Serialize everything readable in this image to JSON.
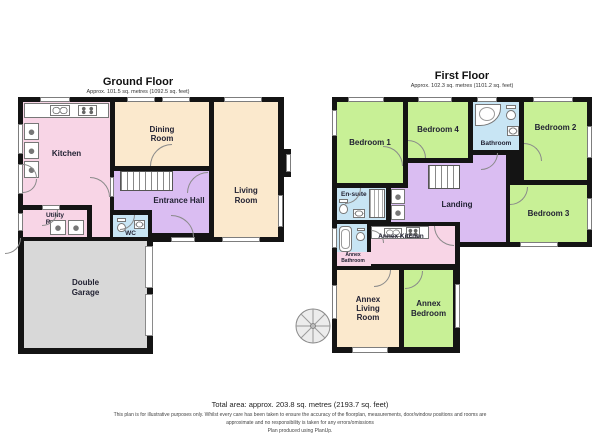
{
  "ground_floor": {
    "title": "Ground Floor",
    "subtitle": "Approx. 101.5 sq. metres (1092.5 sq. feet)",
    "rooms": {
      "kitchen": "Kitchen",
      "dining_room": "Dining Room",
      "living_room": "Living Room",
      "entrance_hall": "Entrance Hall",
      "utility_room": "Utility Room",
      "wc": "WC",
      "double_garage": "Double Garage"
    }
  },
  "first_floor": {
    "title": "First Floor",
    "subtitle": "Approx. 102.3 sq. metres (1101.2 sq. feet)",
    "rooms": {
      "bedroom_1": "Bedroom 1",
      "bedroom_2": "Bedroom 2",
      "bedroom_3": "Bedroom 3",
      "bedroom_4": "Bedroom 4",
      "bathroom": "Bathroom",
      "en_suite": "En-suite",
      "landing": "Landing",
      "annex_kitchen": "Annex Kitchen",
      "annex_bathroom": "Annex Bathroom",
      "annex_living_room": "Annex Living Room",
      "annex_bedroom": "Annex Bedroom"
    }
  },
  "footer": {
    "total_area": "Total area: approx. 203.8 sq. metres (2193.7 sq. feet)",
    "disclaimer": "This plan is for illustrative purposes only. Whilst every care has been taken to ensure the accuracy of the floorplan, measurements, door/window positions and rooms are approximate and no responsibility is taken for any errors/omissions",
    "credit": "Plan produced using PlanUp."
  },
  "colors": {
    "room_pink": "#f8d5e6",
    "room_beige": "#fbe9cd",
    "room_purple": "#dabdf2",
    "room_blue": "#c8e5f4",
    "room_green": "#c8f096",
    "garage_gray": "#d8d8d8",
    "wall_black": "#141414"
  }
}
